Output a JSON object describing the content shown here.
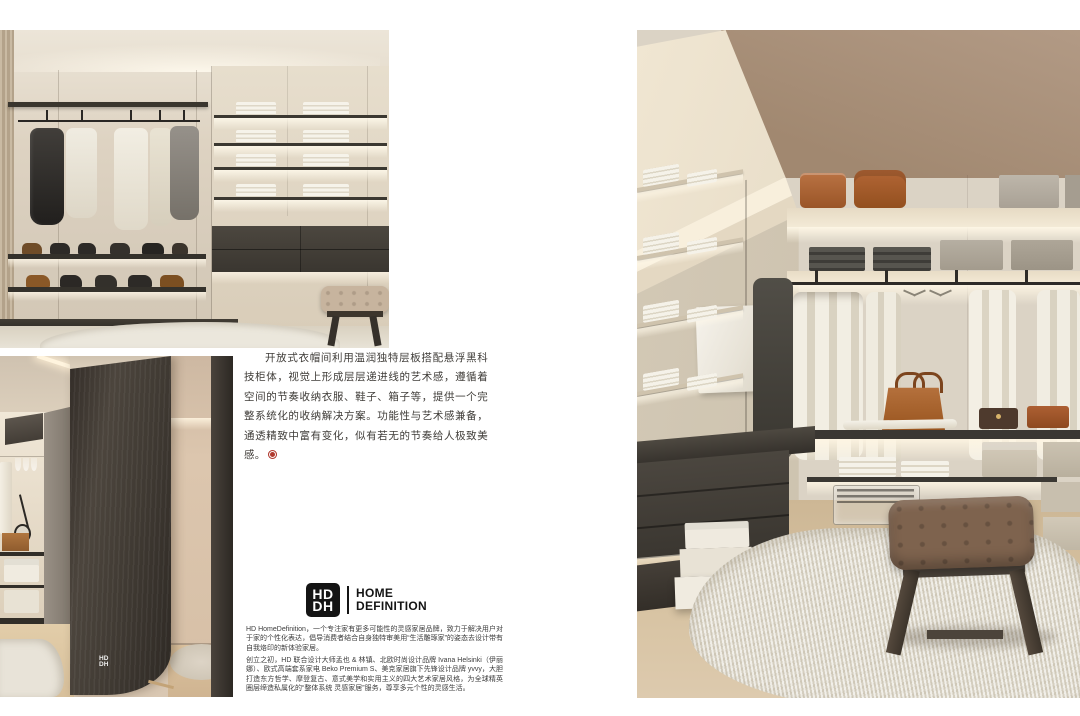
{
  "article": {
    "intro_paragraph": "开放式衣帽间利用温润独特层板搭配悬浮黑科技柜体，视觉上形成层层递进线的艺术感，遵循着空间的节奏收纳衣服、鞋子、箱子等，提供一个完整系统化的收纳解决方案。功能性与艺术感兼备，通透精致中富有变化，似有若无的节奏给人极致美感。",
    "end_seal_color": "#b0392e"
  },
  "brand": {
    "monogram_top": "HD",
    "monogram_bottom": "DH",
    "name_line1": "HOME",
    "name_line2": "DEFINITION",
    "about_paragraph": "HD HomeDefinition，一个专注家有更多可能性的灵感家居品牌，致力于解决用户对于家的个性化表达，倡导消费者结合自身独特审美用“生活雕琢家”的姿态去设计带有自我烙印的新体验家居。",
    "history_paragraph": "创立之初，HD 联合设计大师孟也 & 林镇、北欧时尚设计品牌 Ivana Helsinki（伊丽娜）、欧式高端套系家电 Beko Premium S、美克家居旗下先锋设计品牌 yvvy，大胆打造东方哲学、摩登复古、意式美学和实用主义的四大艺术家居风格，为全球精英圈层缔造私属化的“整体系统 灵感家居”服务，尊享多元个性的灵感生活。"
  },
  "photos": {
    "elevation": {
      "description": "开放式衣帽间立面：挂衣区、鞋架与叠放毛巾层板"
    },
    "partition": {
      "description": "深色弧形木饰面隔断空间",
      "watermark_top": "HD",
      "watermark_bottom": "DH"
    },
    "perspective": {
      "description": "步入式衣帽间透视：长凳与长绒地毯"
    }
  },
  "colors": {
    "page_background": "#ffffff",
    "text": "#3f3c38",
    "logo_black": "#141414",
    "seal_red": "#b0392e",
    "closet_cream": "#d8d0c2",
    "ceiling_taupe": "#a8907c",
    "cabinet_dark": "#3a3630",
    "leather_tan": "#a95f30",
    "bench_brown": "#7e634e"
  }
}
